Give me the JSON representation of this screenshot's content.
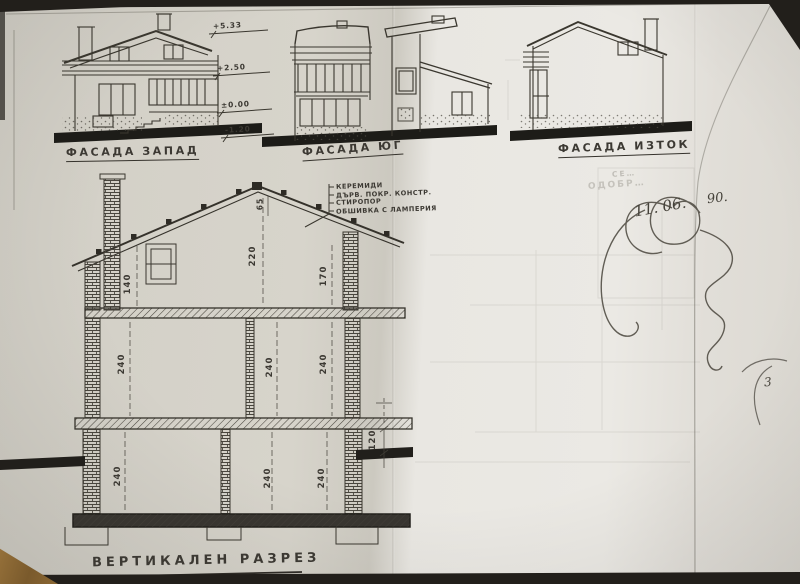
{
  "photo": {
    "background": "#242320",
    "paper_tone_left": "#d6d3ca",
    "paper_tone_right": "#e8e6e1",
    "ink": "#3f3c35"
  },
  "facades": [
    {
      "label": "ФАСАДА ЗАПАД"
    },
    {
      "label": "ФАСАДА ЮГ"
    },
    {
      "label": "ФАСАДА ИЗТОК"
    }
  ],
  "elevation_marks": [
    "+5.33",
    "+2.50",
    "±0.00",
    "-1.20"
  ],
  "section": {
    "title": "ВЕРТИКАЛЕН РАЗРЕЗ",
    "roof_layers": [
      "КЕРЕМИДИ",
      "ДЪРВ. ПОКР. КОНСТР.",
      "СТИРОПОР",
      "ОБШИВКА С ЛАМПЕРИЯ"
    ],
    "dims": {
      "rafter": "65",
      "attic_height": "220",
      "attic_window": "140",
      "knee_wall": "170",
      "floor2": [
        "240",
        "240",
        "240"
      ],
      "floor1": [
        "240",
        "240",
        "240"
      ],
      "plinth": "120"
    }
  },
  "handwriting": {
    "stamp_line1": "СЕ…",
    "stamp_line2": "ОДОБР…",
    "date": "11. 06.",
    "year": "90.",
    "page_mark": "3"
  }
}
